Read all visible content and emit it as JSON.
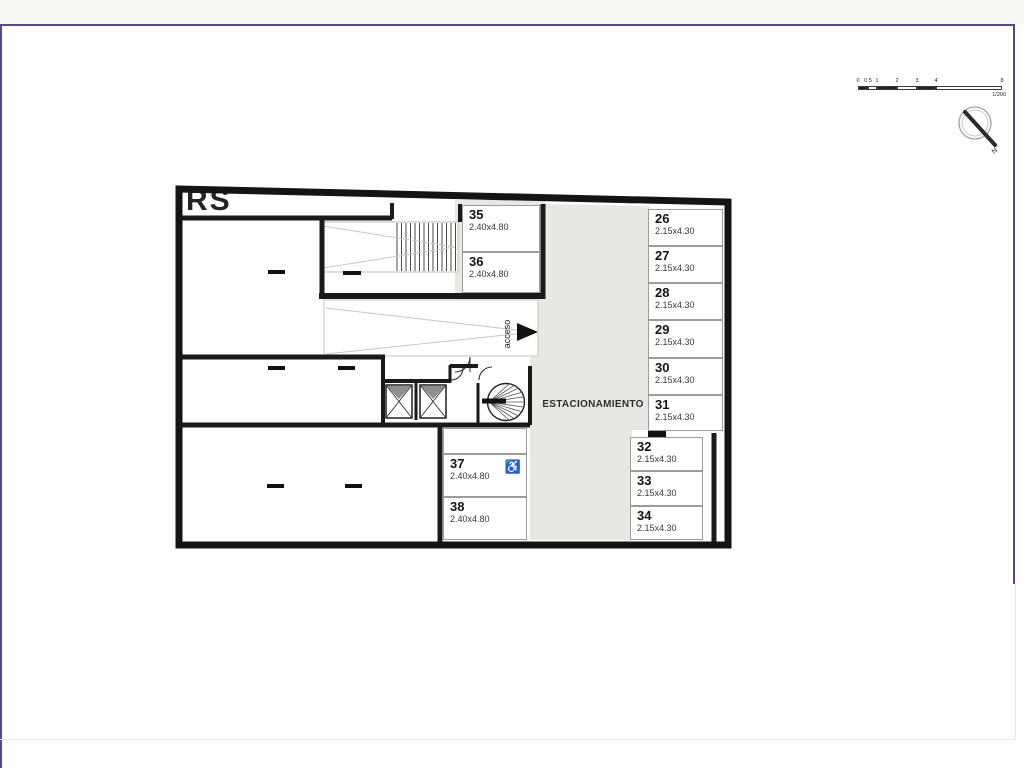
{
  "watermark": "RS",
  "plan": {
    "area_label": "ESTACIONAMIENTO",
    "access_label": "acceso",
    "accessible_icon_glyph": "♿",
    "spots": [
      {
        "num": "26",
        "dim": "2.15x4.30"
      },
      {
        "num": "27",
        "dim": "2.15x4.30"
      },
      {
        "num": "28",
        "dim": "2.15x4.30"
      },
      {
        "num": "29",
        "dim": "2.15x4.30"
      },
      {
        "num": "30",
        "dim": "2.15x4.30"
      },
      {
        "num": "31",
        "dim": "2.15x4.30"
      },
      {
        "num": "32",
        "dim": "2.15x4.30"
      },
      {
        "num": "33",
        "dim": "2.15x4.30"
      },
      {
        "num": "34",
        "dim": "2.15x4.30"
      },
      {
        "num": "35",
        "dim": "2.40x4.80"
      },
      {
        "num": "36",
        "dim": "2.40x4.80"
      },
      {
        "num": "37",
        "dim": "2.40x4.80",
        "accessible": true
      },
      {
        "num": "38",
        "dim": "2.40x4.80"
      }
    ]
  },
  "scale_bar": {
    "ticks": [
      "0",
      "0.5",
      "1",
      "2",
      "3",
      "4",
      "8"
    ],
    "ratio": "1/200"
  },
  "compass": {
    "north_label": "N"
  },
  "colors": {
    "wall": "#1a1a1a",
    "aisle_gray": "#e7e7e4",
    "frame_purple": "#4c4c96"
  }
}
